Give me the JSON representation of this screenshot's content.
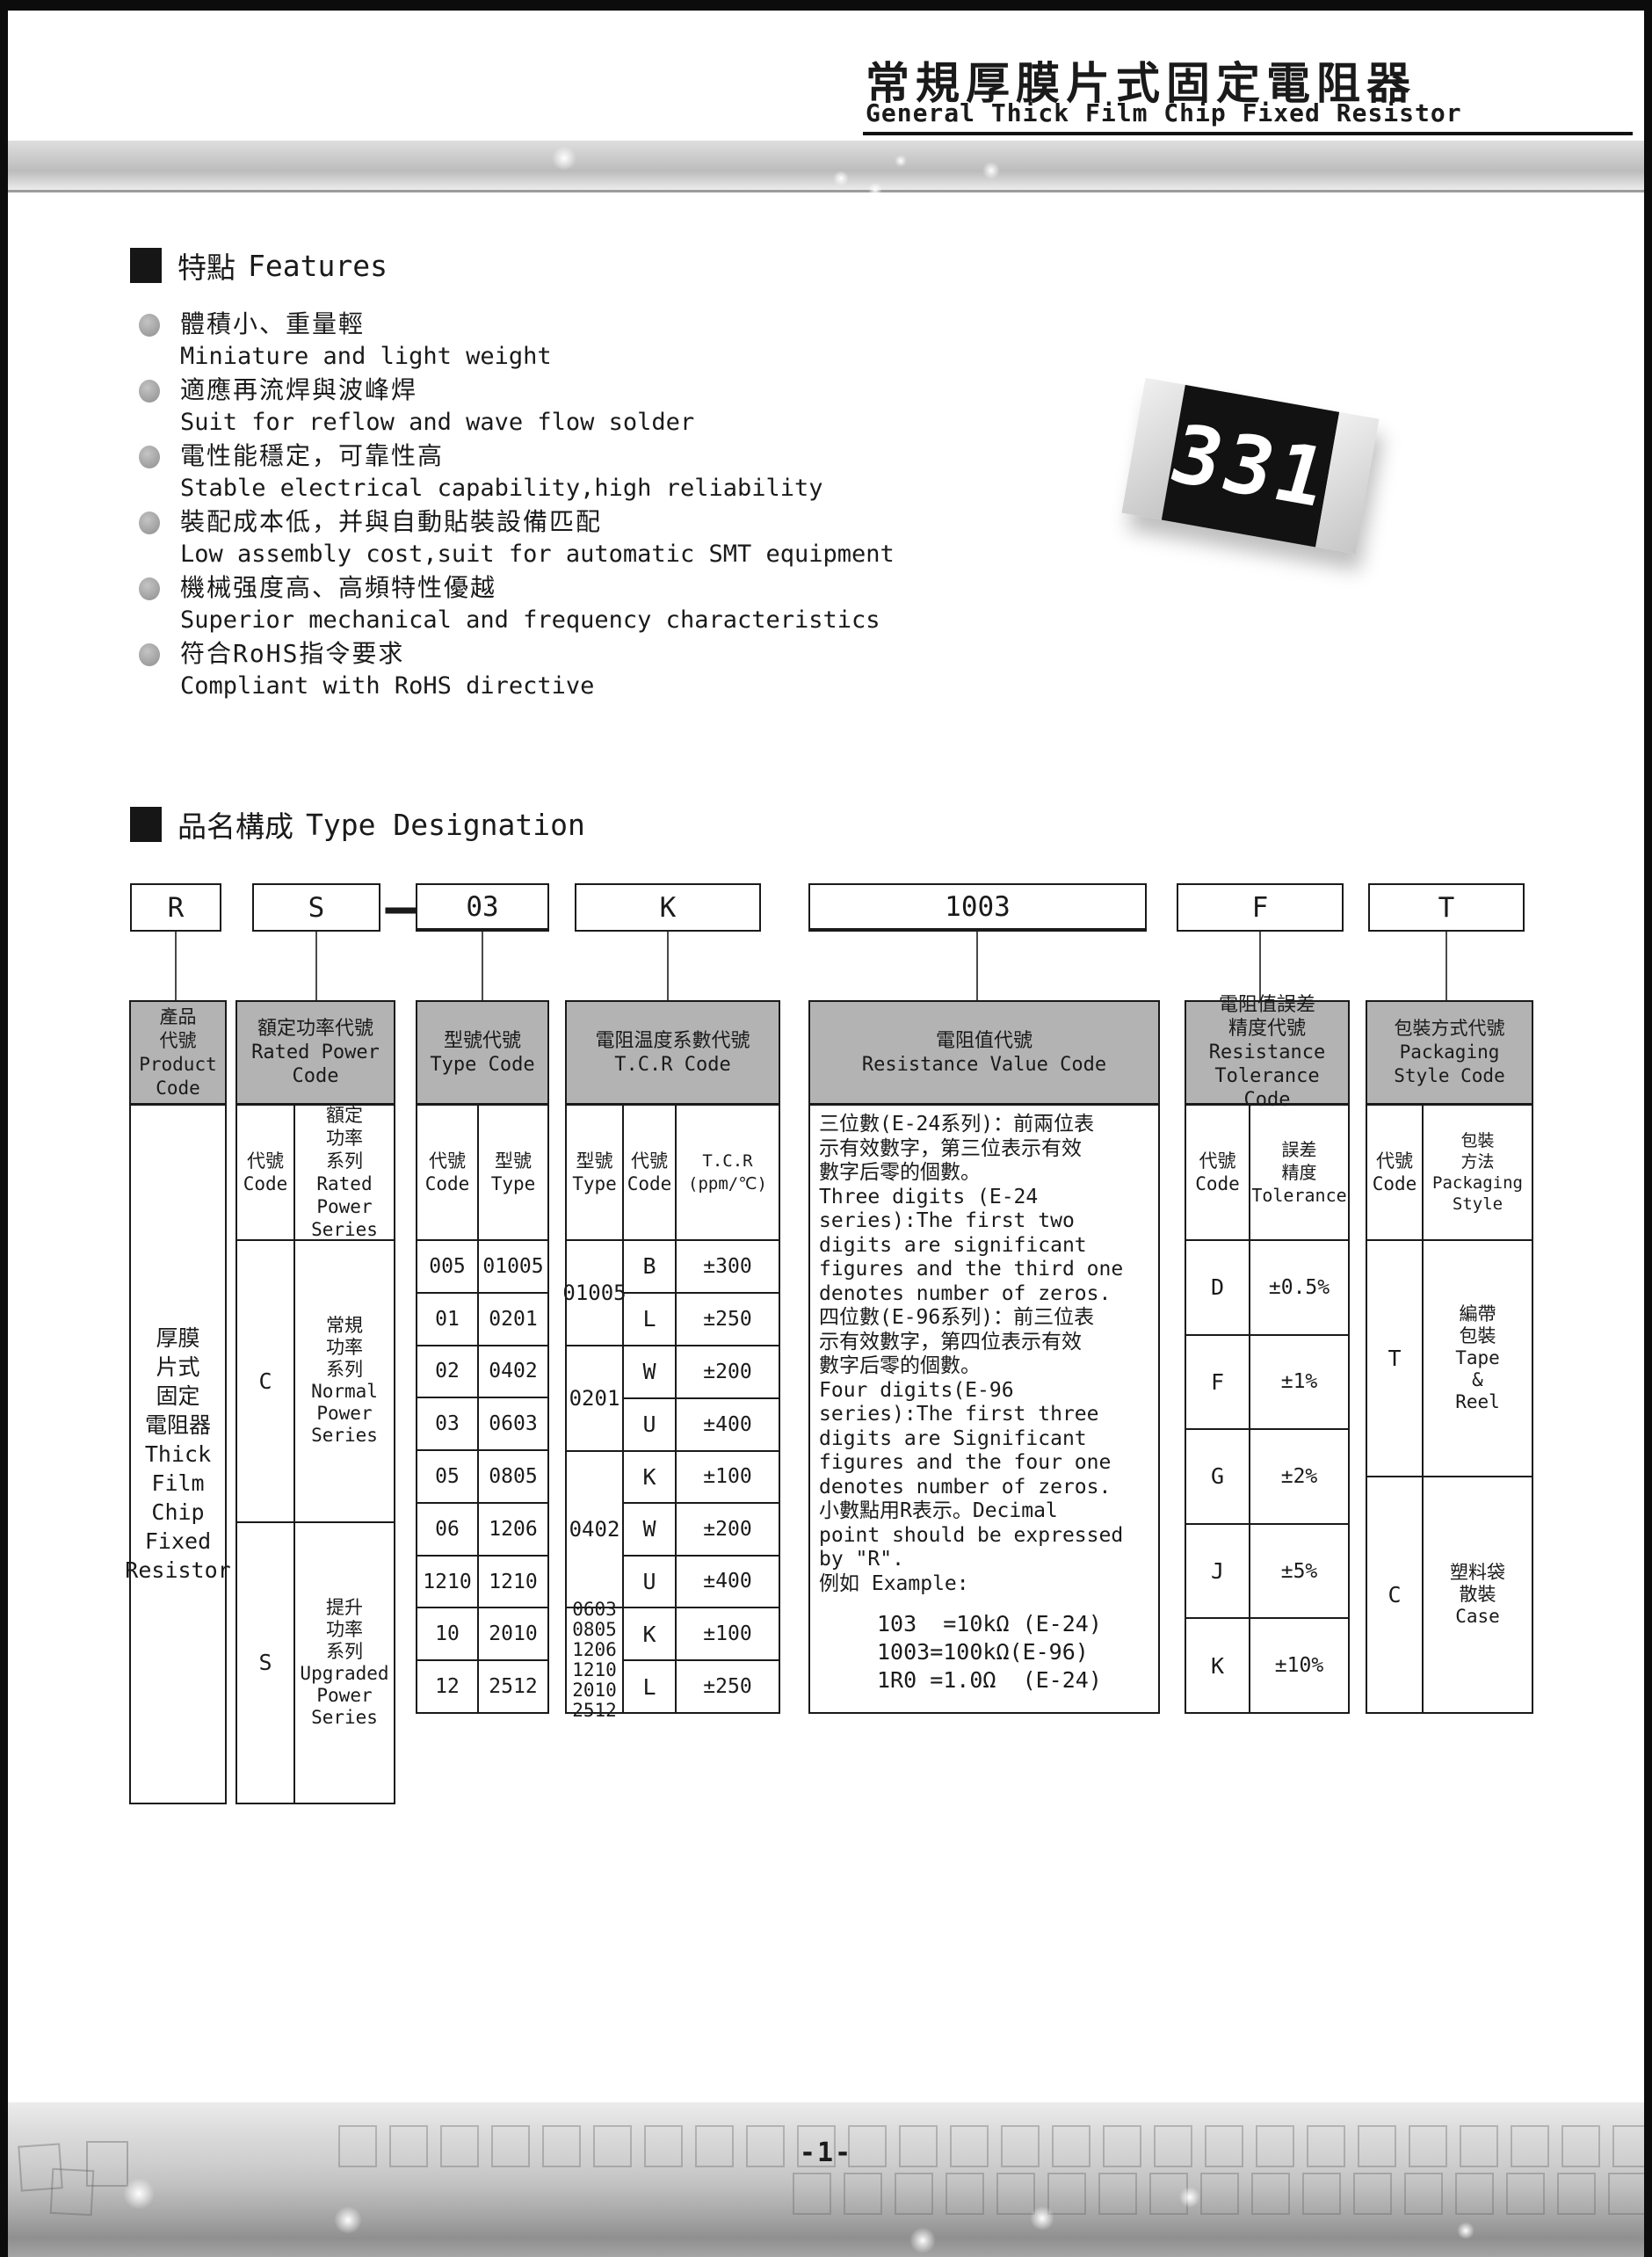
{
  "colors": {
    "table_header_bg": "#b3b3b3",
    "chip_body": "#121212"
  },
  "header": {
    "title_zh": "常規厚膜片式固定電阻器",
    "title_en": "General Thick Film Chip Fixed Resistor"
  },
  "features": {
    "heading_zh": "特點",
    "heading_en": "Features",
    "items": [
      {
        "zh": "體積小、重量輕",
        "en": "Miniature and light weight"
      },
      {
        "zh": "適應再流焊與波峰焊",
        "en": "Suit for reflow and wave flow solder"
      },
      {
        "zh": "電性能穩定，可靠性高",
        "en": "Stable electrical capability,high reliability"
      },
      {
        "zh": "裝配成本低，并與自動貼裝設備匹配",
        "en": "Low assembly cost,suit for automatic SMT equipment"
      },
      {
        "zh": "機械强度高、高頻特性優越",
        "en": "Superior mechanical and frequency characteristics"
      },
      {
        "zh": "符合RoHS指令要求",
        "en": "Compliant with RoHS directive"
      }
    ]
  },
  "chip": {
    "marking": "331"
  },
  "designation": {
    "heading_zh": "品名構成",
    "heading_en": "Type Designation",
    "separator": "—",
    "boxes": [
      "R",
      "S",
      "03",
      "K",
      "1003",
      "F",
      "T"
    ]
  },
  "table": {
    "product": {
      "header": "產品\n代號\nProduct\nCode",
      "body": "厚膜\n片式\n固定\n電阻器\nThick\nFilm\nChip\nFixed\nResistor"
    },
    "power": {
      "header": "額定功率代號\nRated Power\nCode",
      "sub_code": "代號\nCode",
      "sub_series": "額定\n功率\n系列\nRated\nPower\nSeries",
      "rows": [
        {
          "code": "C",
          "series": "常規\n功率\n系列\nNormal\nPower\nSeries"
        },
        {
          "code": "S",
          "series": "提升\n功率\n系列\nUpgraded\nPower\nSeries"
        }
      ]
    },
    "type": {
      "header": "型號代號\nType Code",
      "sub_code": "代號\nCode",
      "sub_type": "型號\nType",
      "rows": [
        {
          "code": "005",
          "type": "01005"
        },
        {
          "code": "01",
          "type": "0201"
        },
        {
          "code": "02",
          "type": "0402"
        },
        {
          "code": "03",
          "type": "0603"
        },
        {
          "code": "05",
          "type": "0805"
        },
        {
          "code": "06",
          "type": "1206"
        },
        {
          "code": "1210",
          "type": "1210"
        },
        {
          "code": "10",
          "type": "2010"
        },
        {
          "code": "12",
          "type": "2512"
        }
      ]
    },
    "tcr": {
      "header": "電阻温度系數代號\nT.C.R Code",
      "sub_type": "型號\nType",
      "sub_code": "代號\nCode",
      "sub_tcr": "T.C.R\n(ppm/℃)",
      "groups": [
        {
          "type": "01005",
          "rows": [
            {
              "code": "B",
              "value": "±300"
            },
            {
              "code": "L",
              "value": "±250"
            }
          ]
        },
        {
          "type": "0201",
          "rows": [
            {
              "code": "W",
              "value": "±200"
            },
            {
              "code": "U",
              "value": "±400"
            }
          ]
        },
        {
          "type": "0402",
          "rows": [
            {
              "code": "K",
              "value": "±100"
            },
            {
              "code": "W",
              "value": "±200"
            },
            {
              "code": "U",
              "value": "±400"
            }
          ]
        },
        {
          "type": "0603\n0805\n1206\n1210\n2010\n2512",
          "rows": [
            {
              "code": "K",
              "value": "±100"
            },
            {
              "code": "L",
              "value": "±250"
            }
          ]
        }
      ]
    },
    "value": {
      "header": "電阻值代號\nResistance Value Code",
      "body": "三位數(E-24系列)：前兩位表\n示有效數字，第三位表示有效\n數字后零的個數。\nThree digits (E-24\nseries):The first two\ndigits are significant\nfigures and the third one\ndenotes number of zeros.\n四位數(E-96系列)：前三位表\n示有效數字，第四位表示有效\n數字后零的個數。\nFour digits(E-96\nseries):The first three\ndigits are Significant\nfigures and the four one\ndenotes number of zeros.\n小數點用R表示。Decimal\npoint should be expressed\nby \"R\".\n例如 Example:",
      "examples": "103  =10kΩ (E-24)\n1003=100kΩ(E-96)\n1R0 =1.0Ω  (E-24)"
    },
    "tolerance": {
      "header": "電阻值誤差\n精度代號\nResistance\nTolerance Code",
      "sub_code": "代號\nCode",
      "sub_tol": "誤差\n精度\nTolerance",
      "rows": [
        {
          "code": "D",
          "value": "±0.5%"
        },
        {
          "code": "F",
          "value": "±1%"
        },
        {
          "code": "G",
          "value": "±2%"
        },
        {
          "code": "J",
          "value": "±5%"
        },
        {
          "code": "K",
          "value": "±10%"
        }
      ]
    },
    "packaging": {
      "header": "包裝方式代號\nPackaging\nStyle Code",
      "sub_code": "代號\nCode",
      "sub_style": "包裝\n方法\nPackaging\nStyle",
      "rows": [
        {
          "code": "T",
          "style": "編帶\n包裝\nTape\n&\nReel"
        },
        {
          "code": "C",
          "style": "塑料袋\n散裝\nCase"
        }
      ]
    }
  },
  "footer": {
    "page_number": "-1-"
  }
}
